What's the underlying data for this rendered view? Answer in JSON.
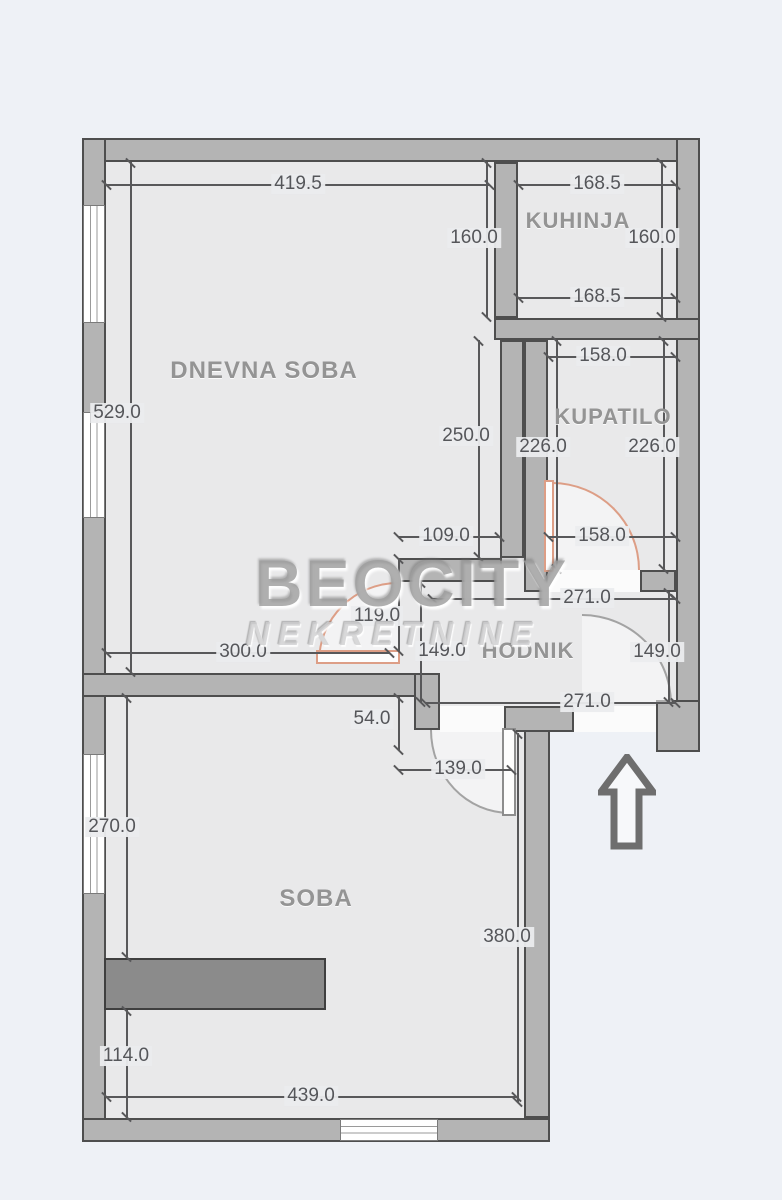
{
  "plan": {
    "watermark_line1": "BEOCITY",
    "watermark_line2": "NEKRETNINE",
    "rooms": {
      "dnevna": "DNEVNA SOBA",
      "kuhinja": "KUHINJA",
      "kupatilo": "KUPATILO",
      "hodnik": "HODNIK",
      "soba": "SOBA"
    },
    "dims": {
      "top_width": "419.5",
      "kitchen_top": "168.5",
      "kitchen_left": "160.0",
      "kitchen_right": "160.0",
      "kitchen_bottom": "168.5",
      "bath_top": "158.0",
      "living_height": "529.0",
      "living_right_height": "250.0",
      "bath_height_left": "226.0",
      "bath_height_right": "226.0",
      "living_door_offset": "109.0",
      "bath_bottom": "158.0",
      "hall_width_top": "271.0",
      "living_door_width": "119.0",
      "living_bottom_width": "300.0",
      "hall_height_left": "149.0",
      "hall_height_right": "149.0",
      "hall_width_bottom": "271.0",
      "wall_step": "54.0",
      "soba_door_width": "139.0",
      "soba_height_upper": "270.0",
      "soba_height_right": "380.0",
      "soba_height_lower": "114.0",
      "soba_width": "439.0"
    },
    "colors": {
      "background": "#eef1f6",
      "floor": "#e9e9ea",
      "wall_fill": "#b4b4b4",
      "wall_outline": "#4e4e4e",
      "door_accent": "#dd9e86",
      "door_gray": "#a3a3a3",
      "dimension_text": "#55565a",
      "room_label": "#949494",
      "furniture": "#8b8b8b"
    }
  }
}
